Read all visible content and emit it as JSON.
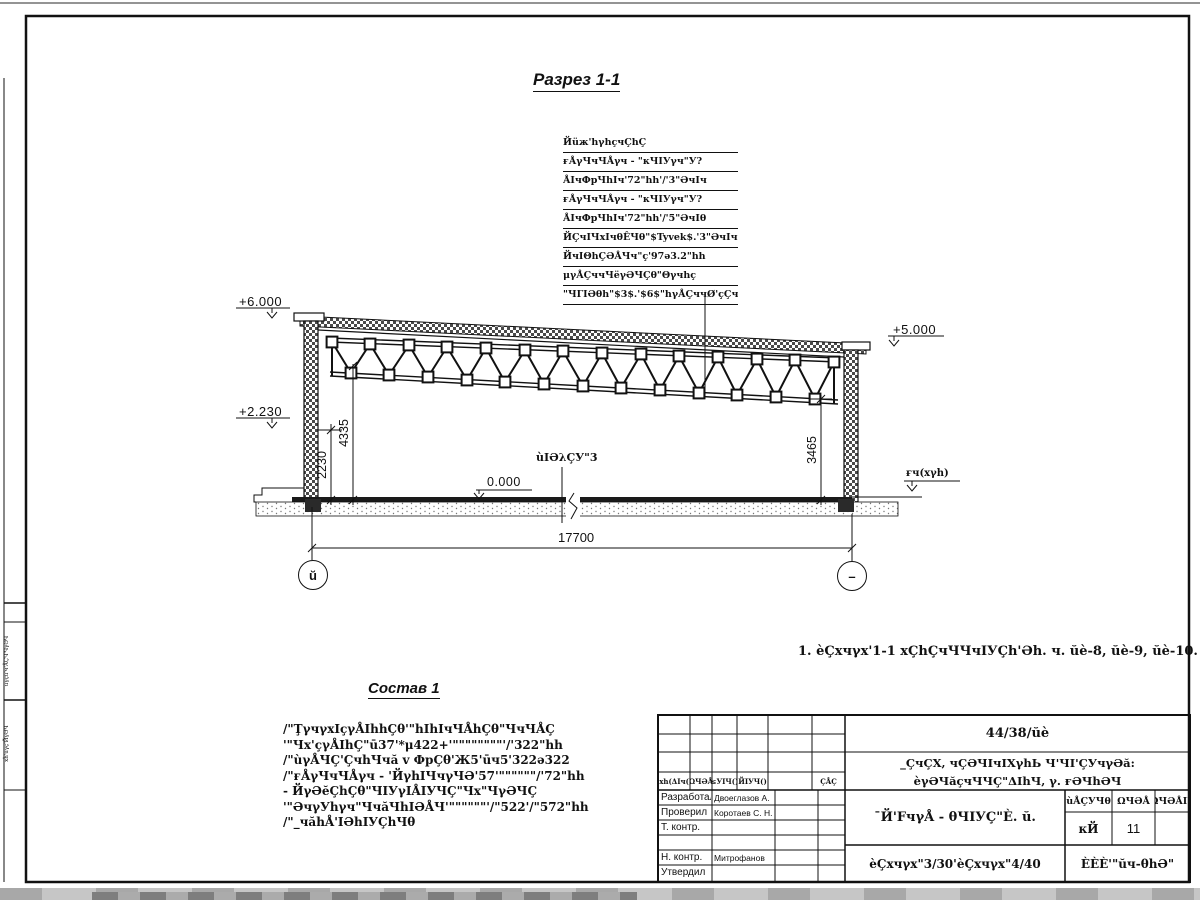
{
  "page": {
    "section_title": "Разрез 1-1",
    "composition_title": "Состав 1",
    "note": "1. èÇхчγх'1-1 хÇhÇчЧЧчIУÇh'Əh. ч. ŭè-8, ŭè-9, ŭè-10."
  },
  "callouts": {
    "header": "Йüж'hγhçчÇhÇ",
    "items": [
      "ғÅγЧчЧÅγч - \"кЧIУγч\"У?372\"Чγ|h5.",
      "ÅIчФрЧhIч'72\"hh'/'3\"ƏчIч",
      "ғÅγЧчЧÅγч - \"кЧIУγч\"У?322\"Чγ|h5.",
      "ÅIчФрЧhIч'72\"hh'/'5\"ƏчIθ",
      "ЙÇчIЧхIчθÊЧθ\"$Tyvek$.'3\"ƏчIч",
      "ЙчIΘhÇƏÅЧч\"ç'97ə3.2\"hh",
      "μγÅÇччЧëγƏЧÇθ\"Θγчhç",
      "\"ЧГIƏθh\"$3$.'$6$\"hγÅÇччØ'çÇчЧЧ+"
    ]
  },
  "composition": {
    "lines": [
      "/\"ŢγчγхIçγÅIhhÇθ'\"hIhIчЧÅhÇθ\"ЧчЧÅÇ",
      "'\"Чх'çγÅIhÇ\"ū37'*μ422+'\"\"\"\"\"\"\"\"'/'322\"hh",
      "/\"ùγÅЧÇ'ÇчhЧчă v ФрÇθ'Ж5'ūч5'322ə322",
      "/\"ғÅγЧчЧÅγч - 'ЙγhIЧчγЧƏ'57'\"\"\"\"\"\"/'72\"hh",
      "- ЙγƏĕÇhÇθ\"ЧIУγIÅIУЧÇ\"Чх\"ЧγƏЧÇ",
      "'\"ƏчγУhγч\"ЧчăЧhIƏÅЧ'\"\"\"\"\"\"'/\"522'/\"572\"hh",
      "/\"_чăhÅ'IƏhIУÇhЧθ"
    ]
  },
  "elevations": {
    "left_top": "+6.000",
    "left_mid": "+2.230",
    "right": "+5.000",
    "zero": "0.000",
    "ground_label": "ғч(хγh)",
    "floor_label": "ùIƏλÇУ\"3"
  },
  "dimensions": {
    "height_2230": "2230",
    "height_4335": "4335",
    "height_3465": "3465",
    "span": "17700"
  },
  "axes": {
    "left": "ŭ",
    "right": "–"
  },
  "title_block": {
    "doc_number": "44/38/ŭè",
    "project_line1": "_ÇчÇХ, чÇƏЧIчIХγhЬ Ч'ЧI'ÇУчγƏă:",
    "project_line2": "èγƏЧăçчЧЧÇ\"ΔIhЧ, γ. ғƏЧhƏЧ",
    "sheet_title": "¯Й'FчγÅ - θЧIУÇ\"È. ŭ.",
    "sheet_subtitle": "èÇхчγх\"3/30'èÇхчγх\"4/40",
    "organization": "ÈÈÈ'\"ŭч-θhƏ\"",
    "change_cols": [
      "¯хh(ΔIч()",
      "ΩЧƏÅ",
      "≤УIЧ()",
      "ЙIУЧ()",
      "",
      "ÇÅÇ"
    ],
    "stage_header": "ùÅÇУЧθ",
    "sheet_header": "ΩЧƏÅ",
    "sheets_header": "ΩЧƏÅIУ",
    "stage_value": "кЙ",
    "sheet_value": "11",
    "roles": [
      {
        "role": "Разработал",
        "name": "Двоеглазов А. В."
      },
      {
        "role": "Проверил",
        "name": "Коротаев С. Н."
      },
      {
        "role": "Т. контр.",
        "name": ""
      },
      {
        "role": "",
        "name": ""
      },
      {
        "role": "Н. контр.",
        "name": "Митрофанов Я. А."
      },
      {
        "role": "Утвердил",
        "name": ""
      }
    ]
  },
  "side_strip": {
    "label1": "ùγçü'ч'ÅÇЧ'ЧγƏЧ",
    "label2": "¯хĥ'üγç'ЙγƏЧ"
  }
}
